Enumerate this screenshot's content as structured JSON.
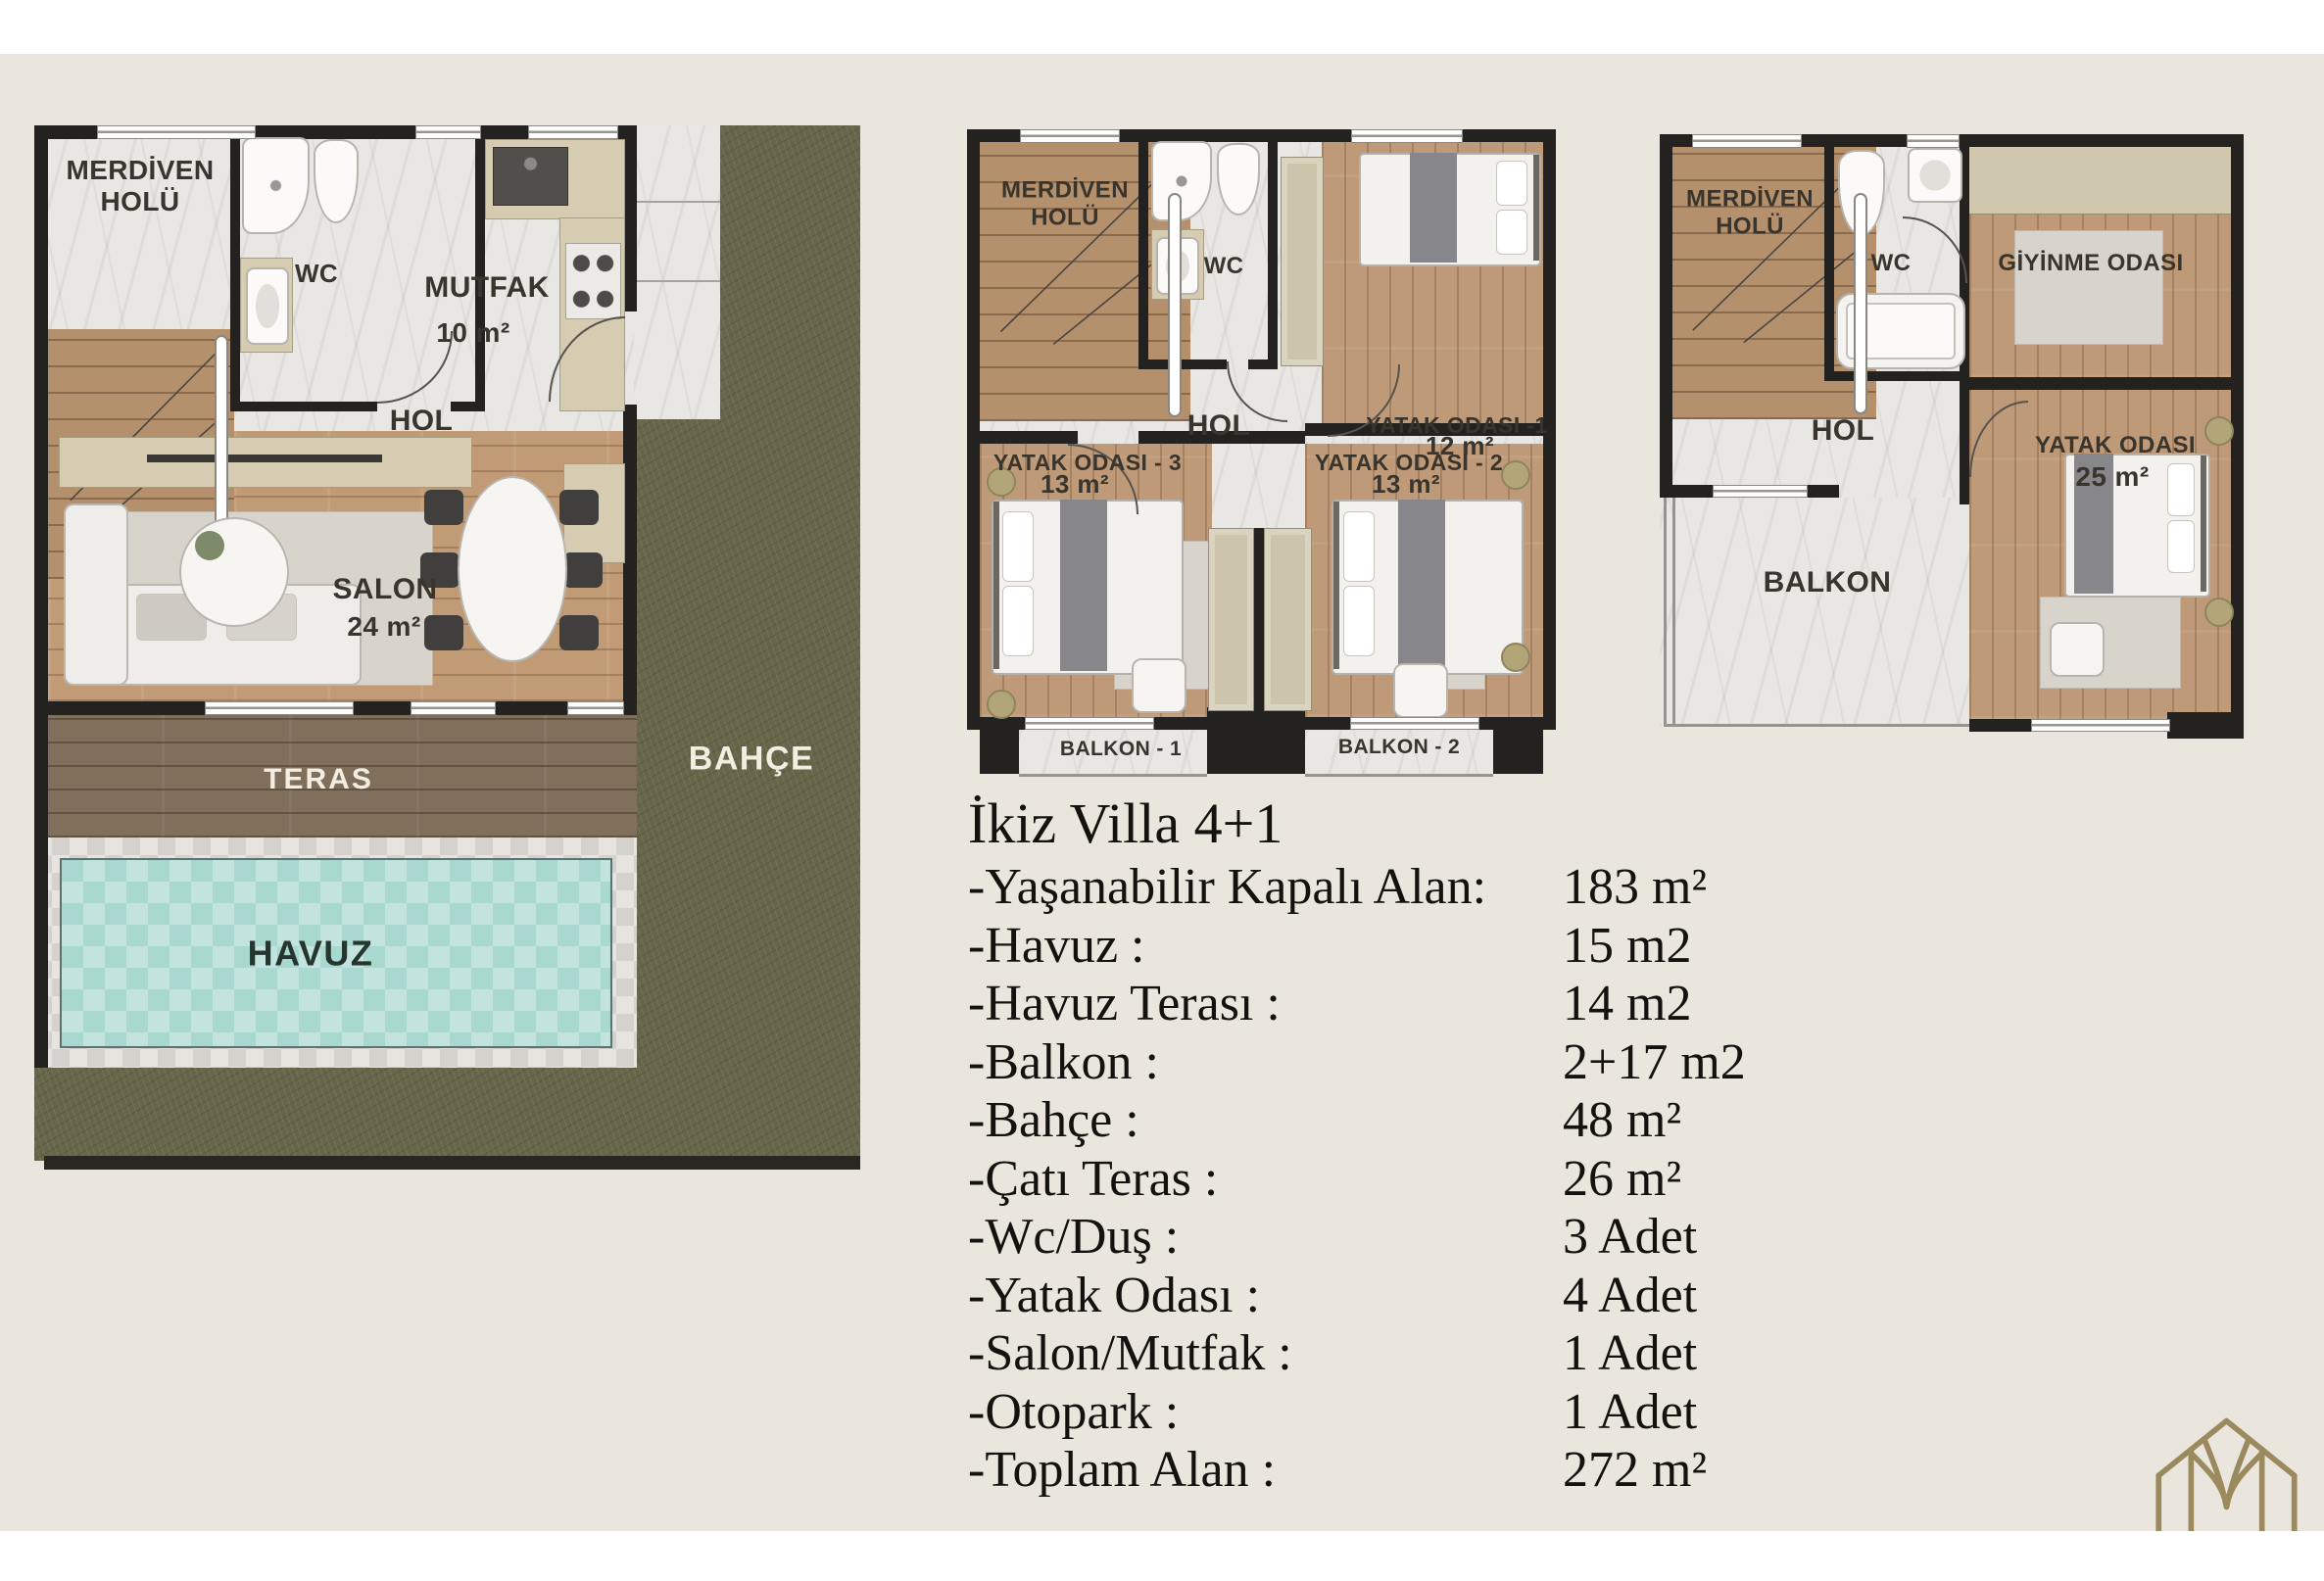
{
  "meta": {
    "document_type": "villa floor plan sheet",
    "floors": [
      "ground floor",
      "first floor",
      "roof floor"
    ]
  },
  "colors": {
    "background": "#eae6de",
    "paper_strip": "#ffffff",
    "wall": "#242220",
    "marble": "#e9e7e3",
    "wood": "#c19b76",
    "deck": "#7f6f5b",
    "grass": "#67664b",
    "pool": "#a9d8d0",
    "counter": "#d5ccb2",
    "logo": "#9a8a5e",
    "spec_text": "#14120f"
  },
  "plans": {
    "ground": {
      "labels": {
        "merdiven": "MERDİVEN HOLÜ",
        "wc": "WC",
        "mutfak": "MUTFAK",
        "mutfak_area": "10 m²",
        "hol": "HOL",
        "salon": "SALON",
        "salon_area": "24 m²",
        "teras": "TERAS",
        "havuz": "HAVUZ",
        "bahce": "BAHÇE"
      }
    },
    "first": {
      "labels": {
        "merdiven": "MERDİVEN HOLÜ",
        "wc": "WC",
        "hol": "HOL",
        "yatak1": "YATAK ODASI -1",
        "yatak1_area": "12 m²",
        "yatak3": "YATAK ODASI - 3",
        "yatak3_area": "13 m²",
        "yatak2": "YATAK ODASI - 2",
        "yatak2_area": "13 m²",
        "balkon1": "BALKON - 1",
        "balkon2": "BALKON - 2"
      }
    },
    "roof": {
      "labels": {
        "merdiven": "MERDİVEN HOLÜ",
        "wc": "WC",
        "giyinme": "GİYİNME ODASI",
        "hol": "HOL",
        "yatak": "YATAK ODASI",
        "yatak_area": "25 m²",
        "balkon": "BALKON"
      }
    }
  },
  "specs": {
    "title": "İkiz Villa 4+1",
    "rows": [
      {
        "label": "-Yaşanabilir Kapalı Alan:",
        "value": "183 m²"
      },
      {
        "label": "-Havuz :",
        "value": "15 m2"
      },
      {
        "label": "-Havuz Terası :",
        "value": "14 m2"
      },
      {
        "label": "-Balkon :",
        "value": "2+17 m2"
      },
      {
        "label": "-Bahçe :",
        "value": "48 m²"
      },
      {
        "label": "-Çatı Teras :",
        "value": "26 m²"
      },
      {
        "label": "-Wc/Duş :",
        "value": "3 Adet"
      },
      {
        "label": "-Yatak Odası :",
        "value": "4 Adet"
      },
      {
        "label": "-Salon/Mutfak :",
        "value": "1 Adet"
      },
      {
        "label": "-Otopark :",
        "value": "1 Adet"
      },
      {
        "label": "-Toplam Alan :",
        "value": "272 m²"
      }
    ]
  }
}
